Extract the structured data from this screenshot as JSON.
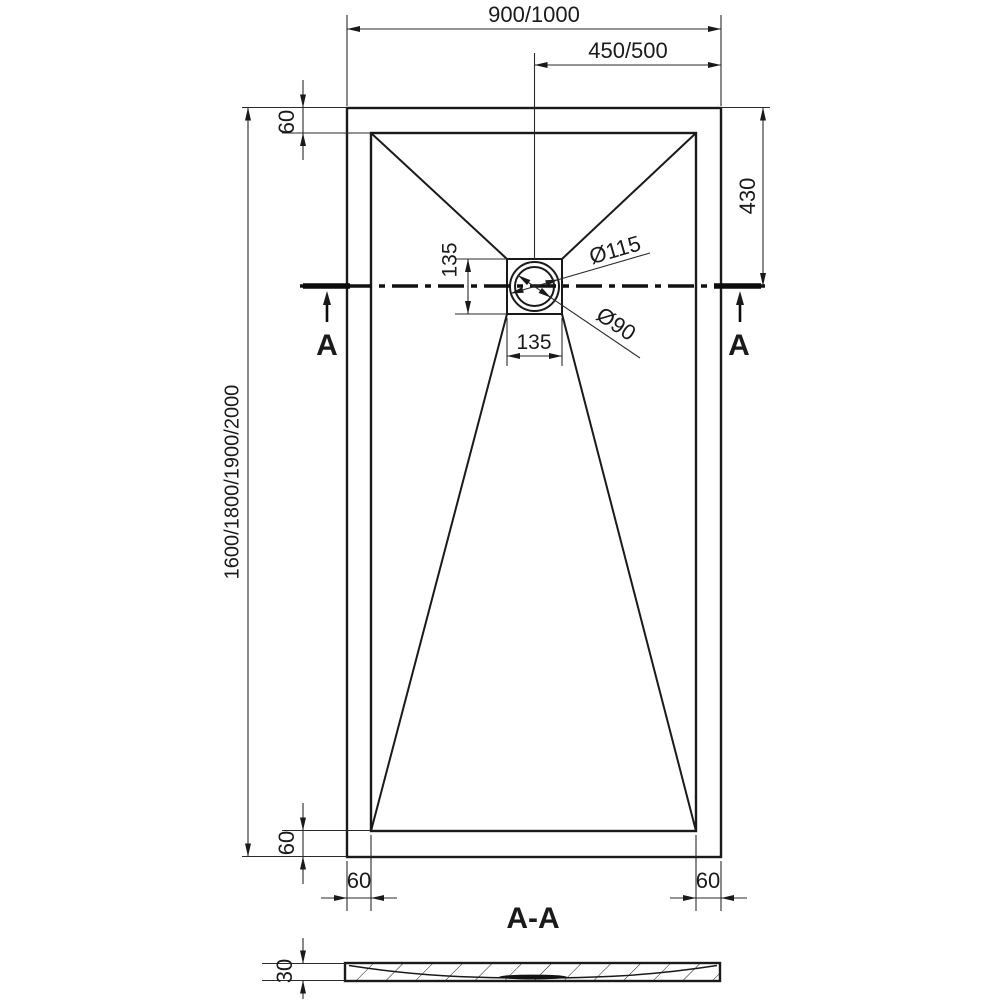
{
  "drawing": {
    "plan": {
      "width_dim": "900/1000",
      "half_width_dim": "450/500",
      "height_dim": "1600/1800/1900/2000",
      "rim_top": "60",
      "rim_bottom": "60",
      "rim_left": "60",
      "rim_right": "60",
      "drain_to_top": "430",
      "drain_box_vertical": "135",
      "drain_box_horizontal": "135",
      "drain_outer_diameter": "Ø115",
      "drain_inner_diameter": "Ø90",
      "section_marker_left": "A",
      "section_marker_right": "A"
    },
    "section": {
      "label": "A-A",
      "thickness": "30"
    },
    "colors": {
      "line": "#1a1a1a",
      "background": "#ffffff"
    }
  }
}
